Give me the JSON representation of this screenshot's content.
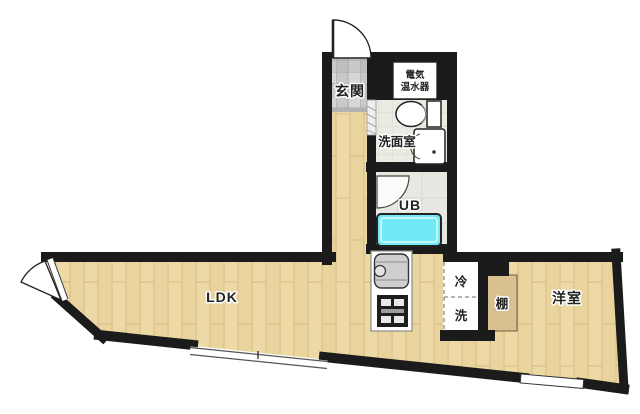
{
  "plan": {
    "labels": {
      "entrance": "玄関",
      "water_heater_line1": "電気",
      "water_heater_line2": "温水器",
      "washroom": "洗面室",
      "unit_bath": "UB",
      "ldk": "LDK",
      "refrigerator": "冷",
      "washer": "洗",
      "shelf": "棚",
      "western_room": "洋室"
    },
    "colors": {
      "wall": "#1b1b1b",
      "text": "#222222",
      "wood_floor": "#edd9a6",
      "wood_grain": "#d8bc82",
      "entrance_tile": "#c9c9c9",
      "tile_line": "#a8a8a8",
      "washroom_floor": "#e9ece3",
      "unit_bath_floor": "#e6e8e1",
      "bathtub": "#72e9f4",
      "shelf_floor": "#d9c08f",
      "background": "#ffffff"
    }
  }
}
